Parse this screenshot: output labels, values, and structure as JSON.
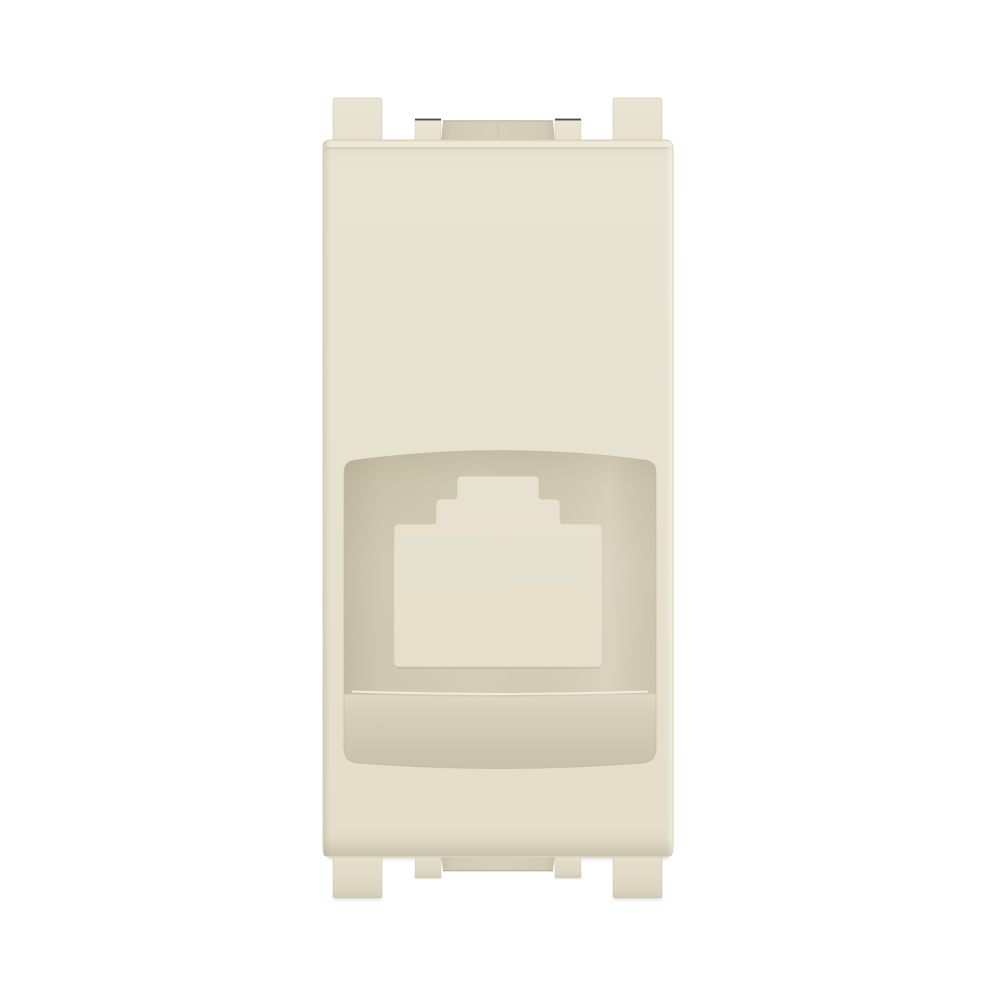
{
  "image": {
    "subject": "Ivory plastic one-module wall faceplate adapter with RJ45 keystone jack opening, front view on white background"
  },
  "module": {
    "parts": {
      "body": "faceplate-body",
      "recess": "socket-recess",
      "cutout": "rj45-jack-opening",
      "outer_tabs": "mounting-tabs",
      "inner_tabs": "latch-tabs",
      "shelf": "recess-shelf"
    }
  },
  "colors": {
    "background": "#ffffff",
    "face": "#e7e1cf",
    "face_top": "#e9e3d2",
    "face_edge_light": "#f1ecdd",
    "face_edge_dark": "#dcd6c1",
    "outline": "#d5cfbb",
    "tab_light": "#eae4d3",
    "tab": "#e6e0ce",
    "tab_dark": "#ddd7c3",
    "tab_edge": "#d2ccb7",
    "channel": "#d2ccb6",
    "channel_light": "#d6d0ba",
    "channel_dark": "#c6bfa9",
    "recess": "#d6d0bb",
    "recess_mid": "#cfc8b2",
    "recess_shadow": "#c5bea7",
    "recess_outline": "#c2bba4",
    "cutout_rim": "#e8e2d0",
    "shelf_light": "#ded8c4",
    "shelf_mid": "#d6d0bb",
    "shelf_dark": "#c8c1aa",
    "ledge_highlight": "#f2eee0",
    "cutout": "#ffffff",
    "contact_shadow": "#aaa390",
    "notch_mark": "#202020"
  }
}
